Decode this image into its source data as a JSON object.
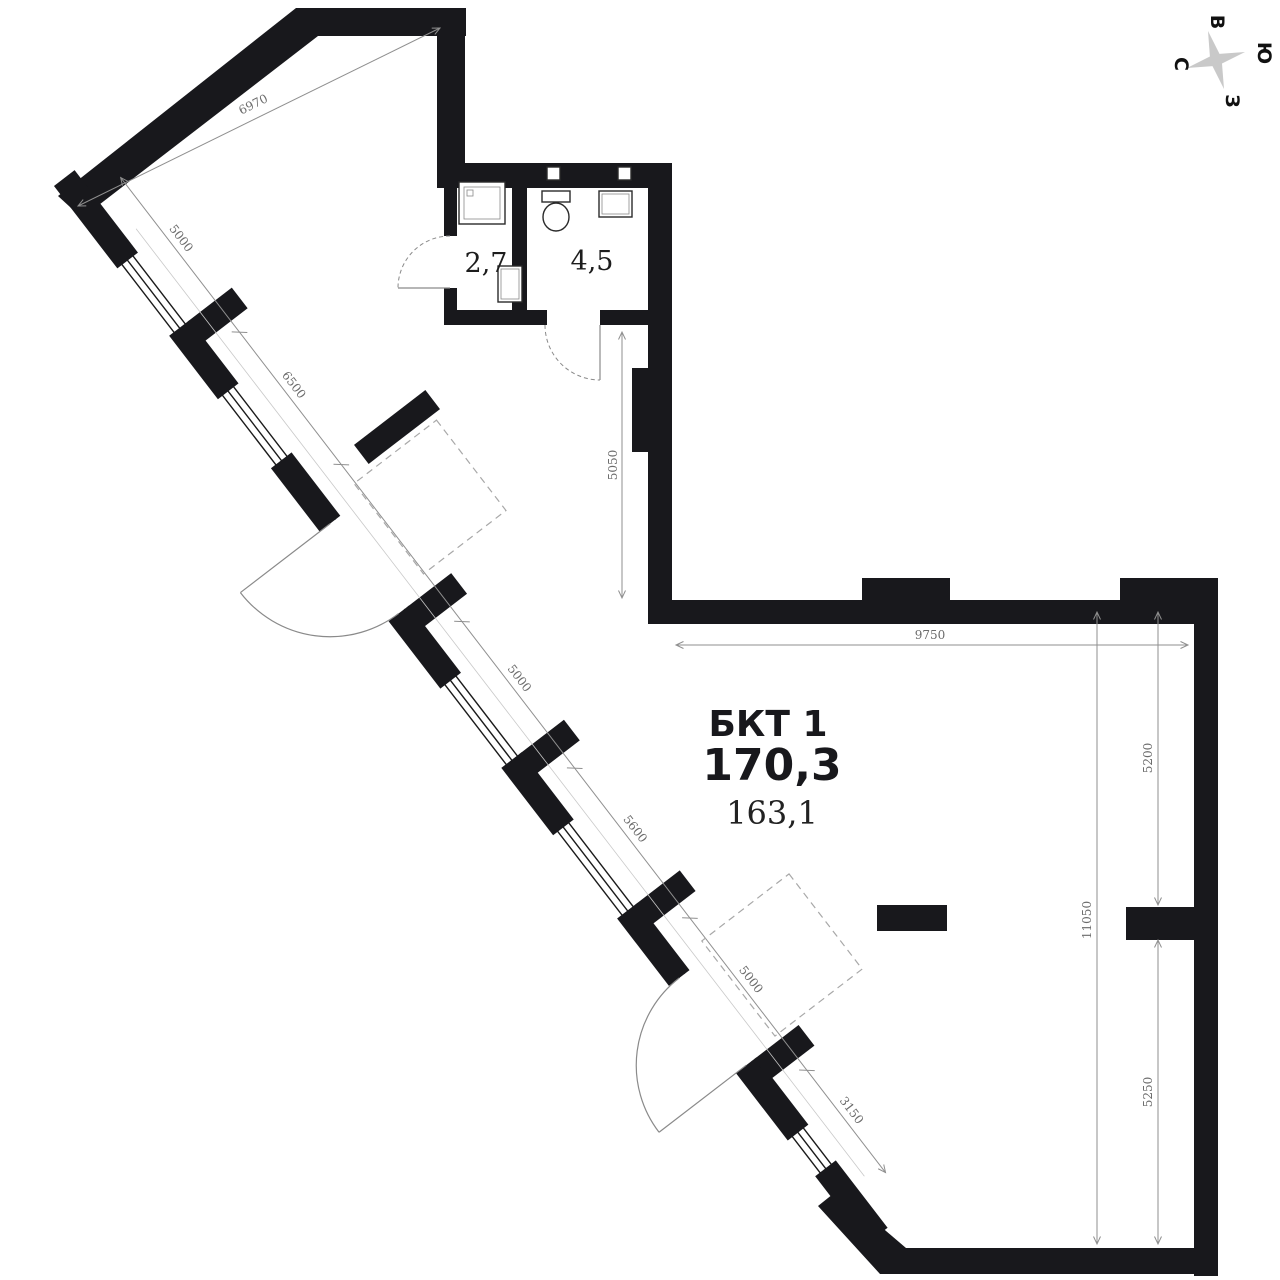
{
  "unit": {
    "name": "БКТ 1",
    "area_main": "170,3",
    "area_alt": "163,1"
  },
  "rooms": {
    "bath_small_area": "2,7",
    "bath_large_area": "4,5"
  },
  "dims": {
    "diag_top": "6970",
    "chain": [
      "5000",
      "6500",
      "5000",
      "5600",
      "5000",
      "3150"
    ],
    "inner_vertical": "5050",
    "top": "9750",
    "right_upper": "5200",
    "right_full": "11050",
    "right_lower": "5250"
  },
  "compass": {
    "north": "С",
    "east": "В",
    "south": "Ю",
    "west": "З"
  },
  "colors": {
    "wall": "#18181c",
    "dimension": "#8f8f8f",
    "star": "#c9c9c9"
  }
}
